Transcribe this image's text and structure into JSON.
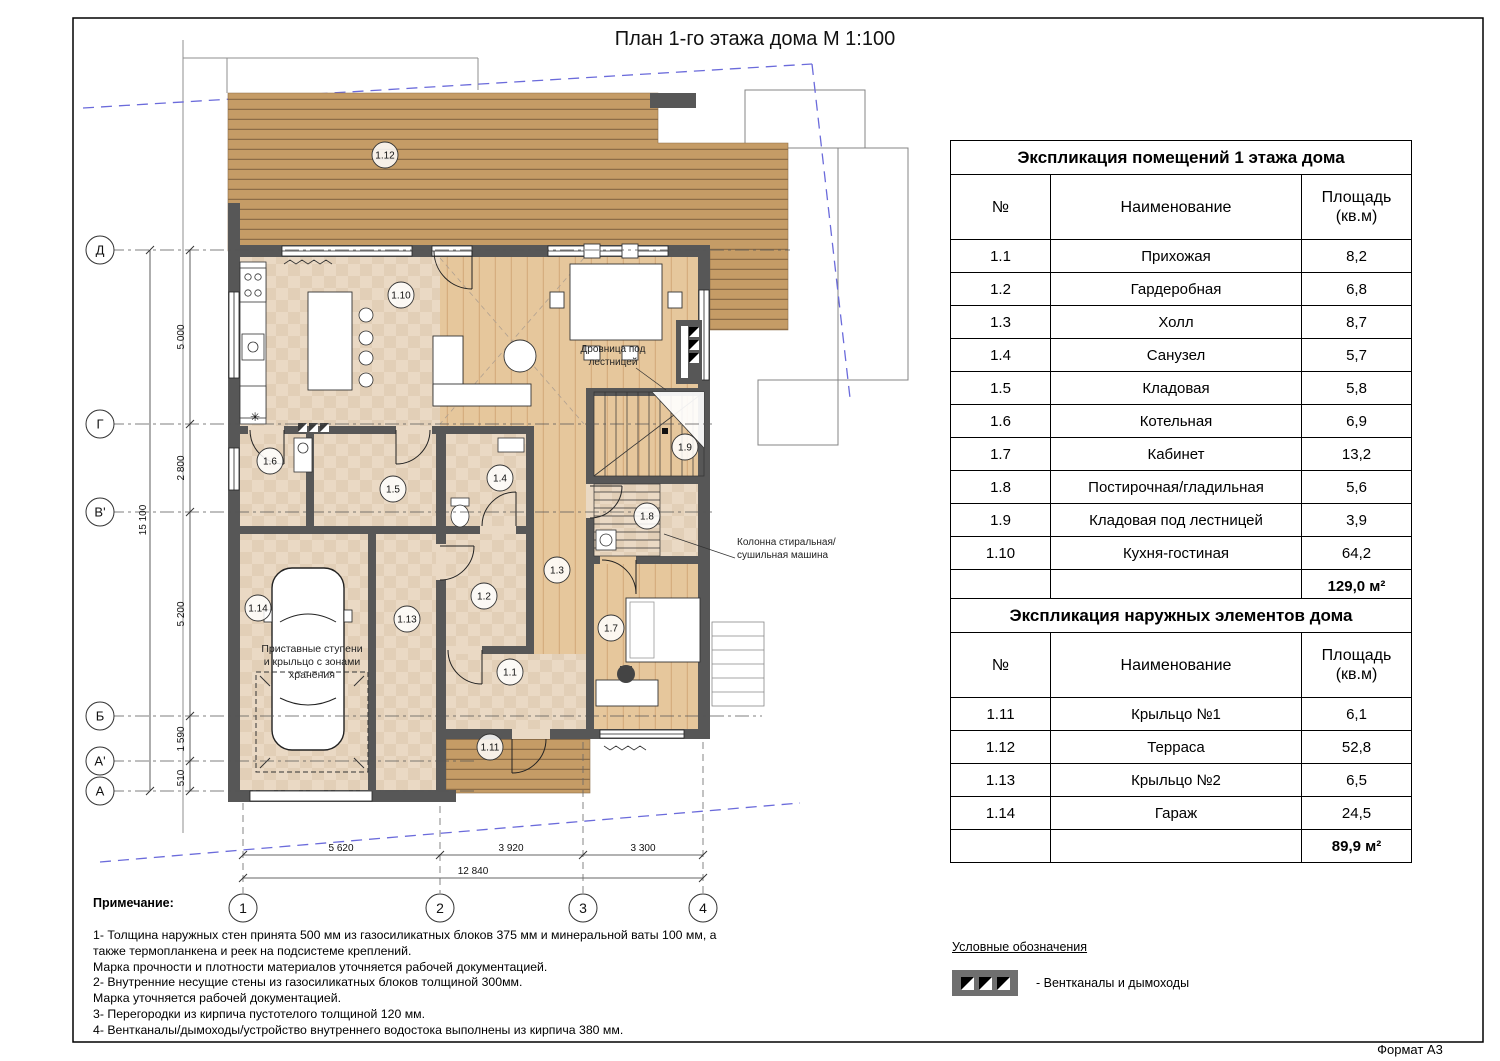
{
  "page": {
    "title": "План 1-го этажа дома М 1:100",
    "format_label": "Формат А3"
  },
  "tables": [
    {
      "title": "Экспликация помещений 1 этажа дома",
      "columns": [
        "№",
        "Наименование",
        "Площадь (кв.м)"
      ],
      "rows": [
        [
          "1.1",
          "Прихожая",
          "8,2"
        ],
        [
          "1.2",
          "Гардеробная",
          "6,8"
        ],
        [
          "1.3",
          "Холл",
          "8,7"
        ],
        [
          "1.4",
          "Санузел",
          "5,7"
        ],
        [
          "1.5",
          "Кладовая",
          "5,8"
        ],
        [
          "1.6",
          "Котельная",
          "6,9"
        ],
        [
          "1.7",
          "Кабинет",
          "13,2"
        ],
        [
          "1.8",
          "Постирочная/гладильная",
          "5,6"
        ],
        [
          "1.9",
          "Кладовая под лестницей",
          "3,9"
        ],
        [
          "1.10",
          "Кухня-гостиная",
          "64,2"
        ]
      ],
      "total": "129,0 м²"
    },
    {
      "title": "Экспликация наружных элементов дома",
      "columns": [
        "№",
        "Наименование",
        "Площадь (кв.м)"
      ],
      "rows": [
        [
          "1.11",
          "Крыльцо №1",
          "6,1"
        ],
        [
          "1.12",
          "Терраса",
          "52,8"
        ],
        [
          "1.13",
          "Крыльцо №2",
          "6,5"
        ],
        [
          "1.14",
          "Гараж",
          "24,5"
        ]
      ],
      "total": "89,9 м²"
    }
  ],
  "notes": {
    "heading": "Примечание:",
    "lines": [
      "1- Толщина наружных стен принята 500 мм из газосиликатных блоков 375 мм и минеральной ваты 100 мм, а",
      "также термопланкена и реек на подсистеме креплений.",
      "Марка прочности и плотности материалов уточняется рабочей документацией.",
      "2- Внутренние несущие стены из газосиликатных блоков толщиной 300мм.",
      "Марка уточняется рабочей документацией.",
      "3- Перегородки из кирпича пустотелого толщиной 120 мм.",
      "4- Вентканалы/дымоходы/устройство внутреннего водостока выполнены из кирпича 380 мм."
    ]
  },
  "legend": {
    "heading": "Условные обозначения",
    "item": "- Вентканалы и дымоходы"
  },
  "plan": {
    "room_markers": [
      {
        "label": "1.1",
        "x": 510,
        "y": 672
      },
      {
        "label": "1.2",
        "x": 484,
        "y": 596
      },
      {
        "label": "1.3",
        "x": 557,
        "y": 570
      },
      {
        "label": "1.4",
        "x": 500,
        "y": 478
      },
      {
        "label": "1.5",
        "x": 393,
        "y": 489
      },
      {
        "label": "1.6",
        "x": 270,
        "y": 461
      },
      {
        "label": "1.7",
        "x": 611,
        "y": 628
      },
      {
        "label": "1.8",
        "x": 647,
        "y": 516
      },
      {
        "label": "1.9",
        "x": 685,
        "y": 447
      },
      {
        "label": "1.10",
        "x": 401,
        "y": 295
      },
      {
        "label": "1.11",
        "x": 490,
        "y": 747
      },
      {
        "label": "1.12",
        "x": 385,
        "y": 155
      },
      {
        "label": "1.13",
        "x": 407,
        "y": 619
      },
      {
        "label": "1.14",
        "x": 258,
        "y": 608
      }
    ],
    "row_axes": [
      {
        "label": "Д",
        "y": 250,
        "x2": 790
      },
      {
        "label": "Г",
        "y": 424,
        "x2": 712
      },
      {
        "label": "В'",
        "y": 512,
        "x2": 712
      },
      {
        "label": "Б",
        "y": 716,
        "x2": 762
      },
      {
        "label": "А'",
        "y": 761,
        "x2": 474
      },
      {
        "label": "А",
        "y": 791,
        "x2": 474
      }
    ],
    "col_axes": [
      {
        "label": "1",
        "x": 243,
        "y1": 803
      },
      {
        "label": "2",
        "x": 440,
        "y1": 806
      },
      {
        "label": "3",
        "x": 583,
        "y1": 742
      },
      {
        "label": "4",
        "x": 703,
        "y1": 742
      }
    ],
    "dims_left": [
      {
        "text": "5 000",
        "y": 337
      },
      {
        "text": "2 800",
        "y": 468
      },
      {
        "text": "5 200",
        "y": 614
      },
      {
        "text": "1 590",
        "y": 739
      },
      {
        "text": "510",
        "y": 778
      },
      {
        "text": "15 100",
        "y": 520,
        "overall": true
      }
    ],
    "dims_bottom": [
      {
        "text": "5 620",
        "x": 341
      },
      {
        "text": "3 920",
        "x": 511
      },
      {
        "text": "3 300",
        "x": 643
      },
      {
        "text": "12 840",
        "x": 473,
        "overall": true
      }
    ],
    "annotations": [
      {
        "lines": [
          "Дровница под",
          "лестницей"
        ],
        "x": 613,
        "y": 352,
        "anchor": "middle",
        "fs": 10,
        "leader": [
          636,
          368,
          666,
          390
        ]
      },
      {
        "lines": [
          "Колонна стиральная/",
          "сушильная машина"
        ],
        "x": 737,
        "y": 545,
        "anchor": "start",
        "fs": 10,
        "leader": [
          735,
          558,
          664,
          534
        ]
      },
      {
        "lines": [
          "Приставные ступени",
          "и крыльцо с зонами",
          "хранения"
        ],
        "x": 312,
        "y": 652,
        "anchor": "middle",
        "fs": 10.5
      }
    ]
  },
  "colors": {
    "wall": "#575757",
    "deck": "#c59c66",
    "deck_stripe": "#8d6d47",
    "tile": "#ead9c4",
    "tile_alt": "#e2cfb7",
    "wood": "#e6c79c",
    "wood_stripe": "#d2a878",
    "boundary_blue": "#6b6bdb"
  }
}
